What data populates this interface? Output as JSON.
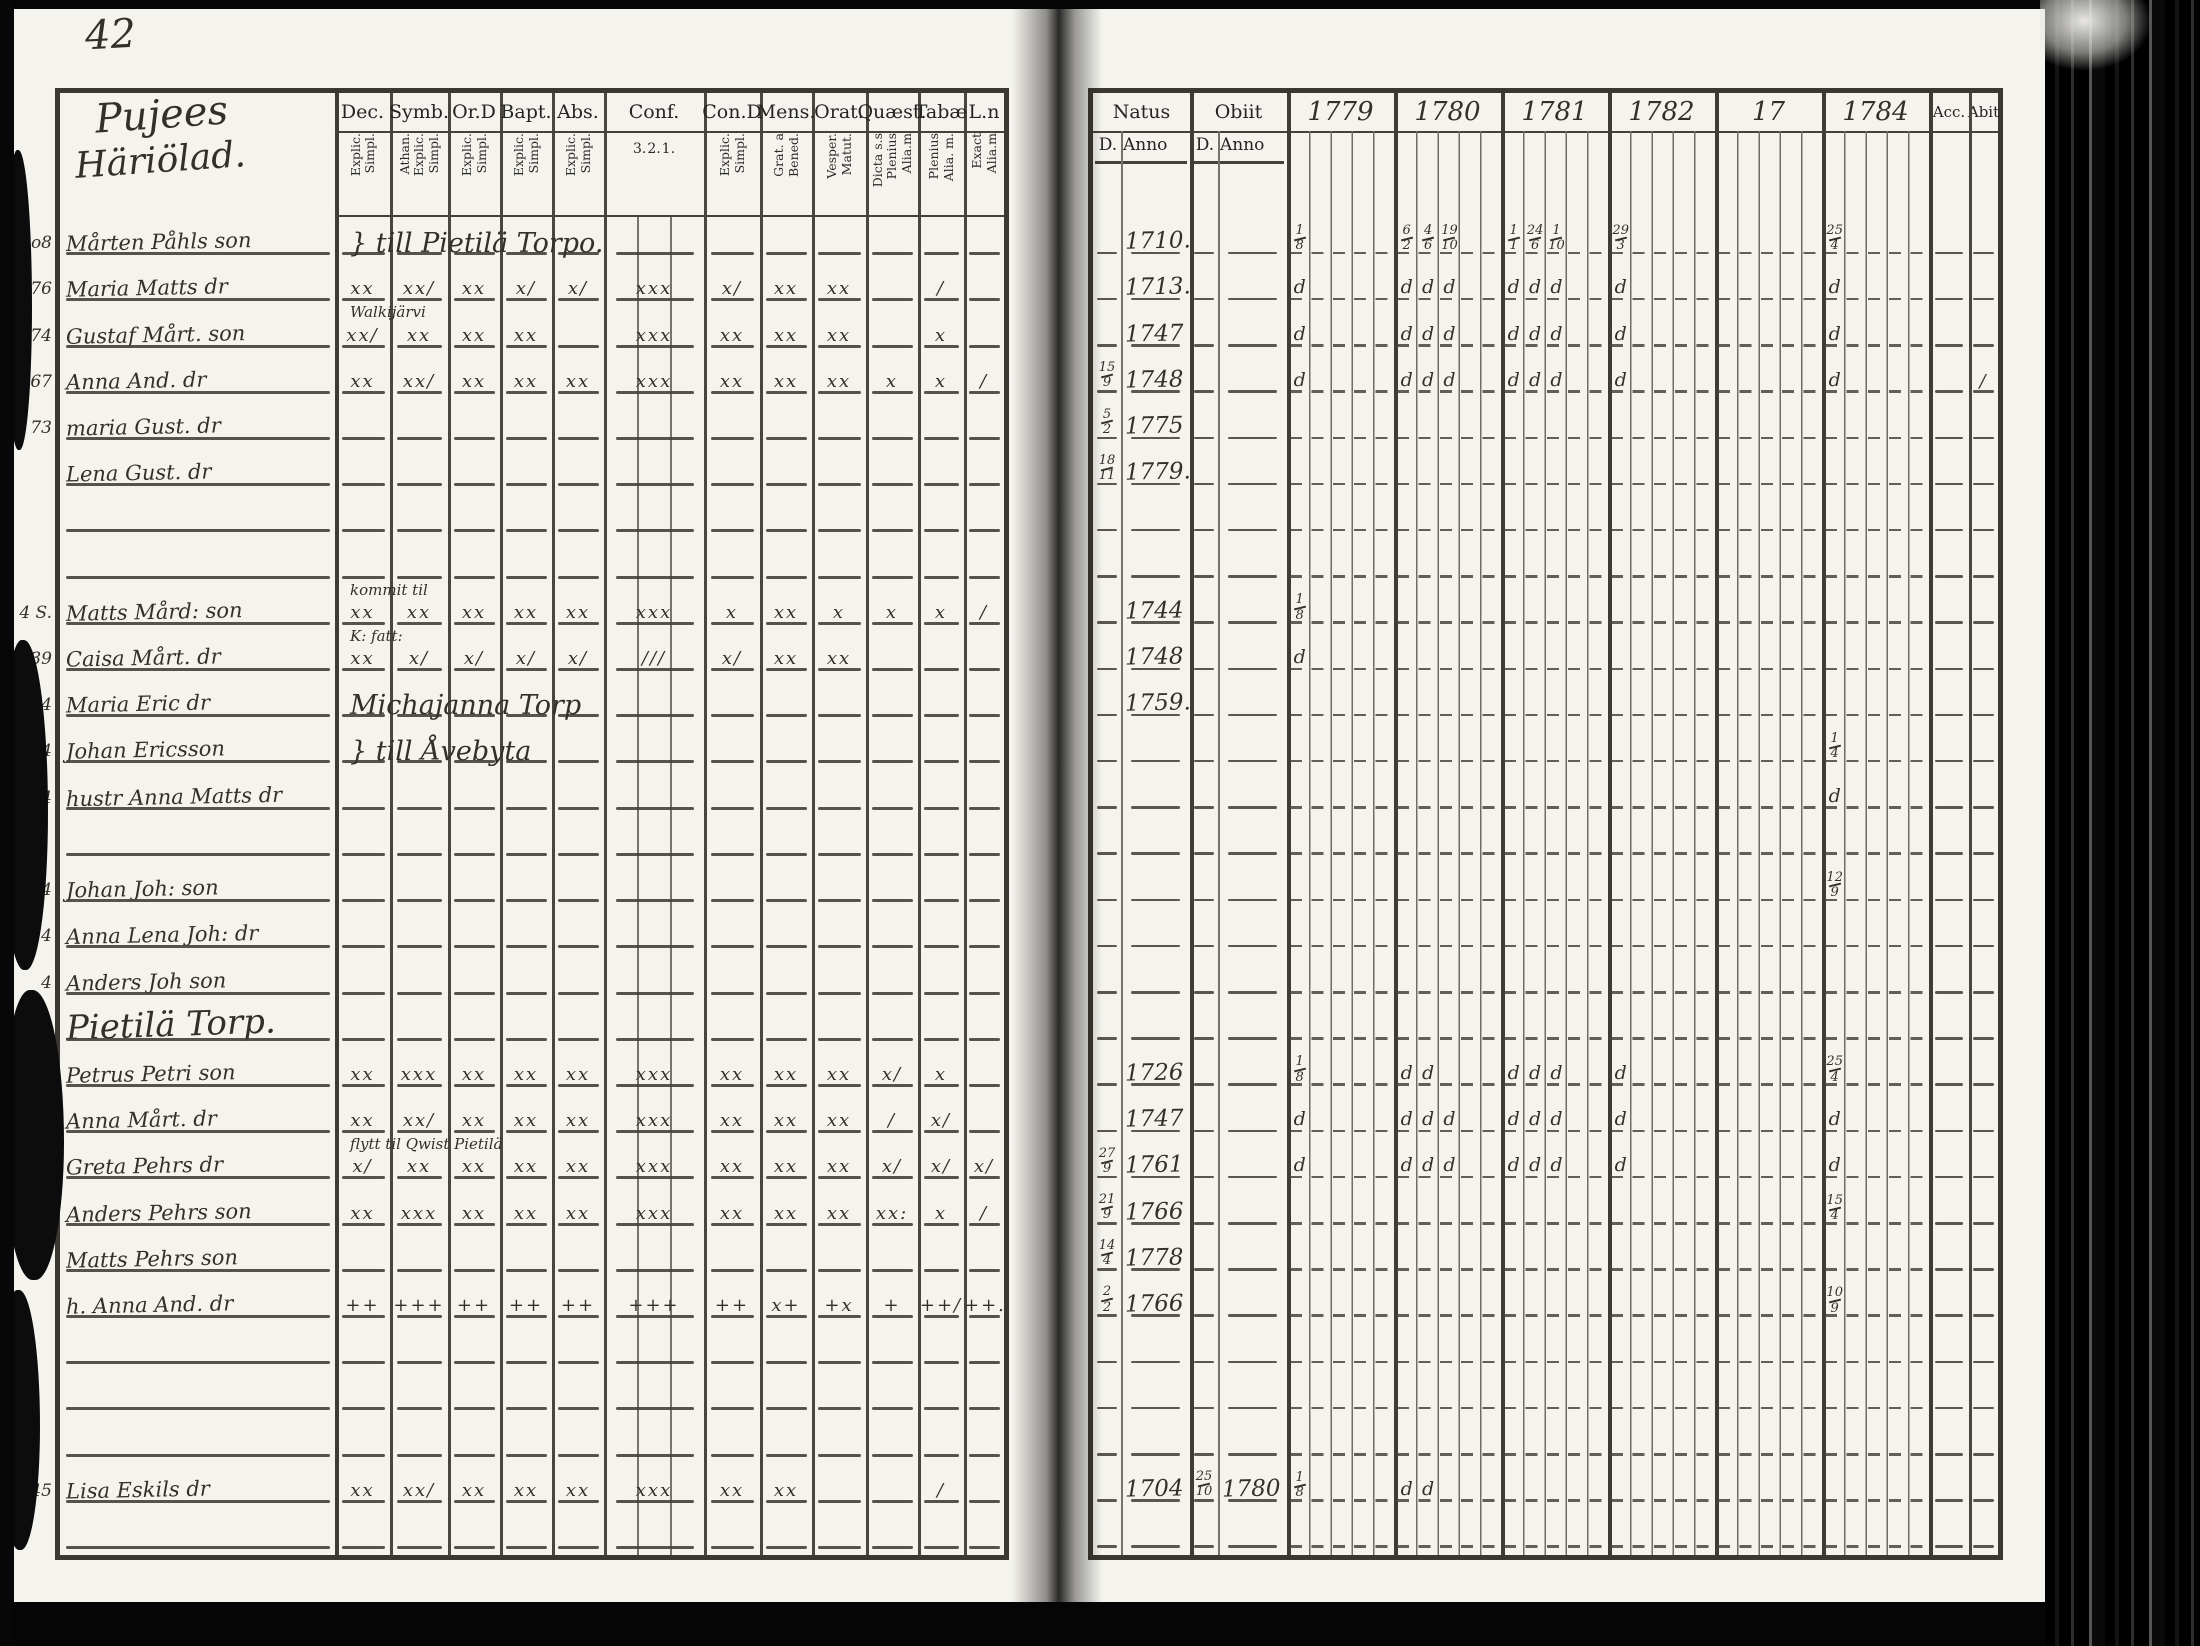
{
  "page_number": "42",
  "left_page": {
    "title_lines": [
      "Pujees",
      "Häriölad."
    ],
    "columns": [
      {
        "label": "Dec.",
        "subs": [
          "Explic.",
          "Simpl."
        ]
      },
      {
        "label": "Symb.",
        "subs": [
          "Athan.",
          "Explic.",
          "Simpl."
        ]
      },
      {
        "label": "Or.D",
        "subs": [
          "Explic.",
          "Simpl."
        ]
      },
      {
        "label": "Bapt.",
        "subs": [
          "Explic.",
          "Simpl."
        ]
      },
      {
        "label": "Abs.",
        "subs": [
          "Explic.",
          "Simpl."
        ]
      },
      {
        "label": "Conf.",
        "subs": [
          "3.",
          "2.",
          "1."
        ],
        "numeric": true
      },
      {
        "label": "Con.D",
        "subs": [
          "Explic.",
          "Simpl."
        ]
      },
      {
        "label": "Mens.",
        "subs": [
          "Grat. a",
          "Bened."
        ]
      },
      {
        "label": "Orat.",
        "subs": [
          "Vesper.",
          "Matut."
        ]
      },
      {
        "label": "Quæst.",
        "subs": [
          "Dicta s.s",
          "Plenius",
          "Alia.m"
        ]
      },
      {
        "label": "Tabæ",
        "subs": [
          "Plenius",
          "Alia. m."
        ]
      },
      {
        "label": "L.n",
        "subs": [
          "Exact",
          "Alia.m"
        ]
      }
    ]
  },
  "right_page": {
    "natus_label": "Natus",
    "obiit_label": "Obiit",
    "day_label": "D.",
    "anno_label": "Anno",
    "year_labels": [
      "1779",
      "1780",
      "1781",
      "1782",
      "17",
      "1784"
    ],
    "acc_label": "Acc.",
    "abit_label": "Abit"
  },
  "rows": [
    {
      "margin": "Lo8",
      "name": "Mårten Påhls son",
      "note": "} till Pietilä Torpo.",
      "note_big": true,
      "natus": "1710.",
      "y1779": [
        "1/8"
      ],
      "y1780": [
        "6/2",
        "4/6",
        "19/10"
      ],
      "y1781": [
        "1/1",
        "24/6",
        "1/10"
      ],
      "y1782": [
        "29/3"
      ],
      "y1784": [
        "25/4"
      ]
    },
    {
      "margin": "76",
      "name": "Maria Matts dr",
      "marks": [
        "xx",
        "xx/",
        "xx",
        "x/",
        "x/",
        "xxx",
        "x/",
        "xx",
        "xx",
        "",
        "/",
        ""
      ],
      "natus": "1713.",
      "y1779": [
        "d"
      ],
      "y1780": [
        "d",
        "d",
        "d"
      ],
      "y1781": [
        "d",
        "d",
        "d"
      ],
      "y1782": [
        "d"
      ],
      "y1784": [
        "d"
      ]
    },
    {
      "margin": "74",
      "name": "Gustaf Mårt. son",
      "note": "Walkijärvi",
      "marks": [
        "xx/",
        "xx",
        "xx",
        "xx",
        "",
        "xxx",
        "xx",
        "xx",
        "xx",
        "",
        "x",
        ""
      ],
      "natus": "1747",
      "y1779": [
        "d"
      ],
      "y1780": [
        "d",
        "d",
        "d"
      ],
      "y1781": [
        "d",
        "d",
        "d"
      ],
      "y1782": [
        "d"
      ],
      "y1784": [
        "d"
      ]
    },
    {
      "margin": "67",
      "name": "Anna And. dr",
      "marks": [
        "xx",
        "xx/",
        "xx",
        "xx",
        "xx",
        "xxx",
        "xx",
        "xx",
        "xx",
        "x",
        "x",
        "/"
      ],
      "natus_d": "15/9",
      "natus": "1748",
      "y1779": [
        "d"
      ],
      "y1780": [
        "d",
        "d",
        "d"
      ],
      "y1781": [
        "d",
        "d",
        "d"
      ],
      "y1782": [
        "d"
      ],
      "y1784": [
        "d"
      ],
      "abit": "/"
    },
    {
      "margin": "73",
      "name": "maria Gust. dr",
      "natus_d": "5/2",
      "natus": "1775"
    },
    {
      "margin": "",
      "name": "Lena Gust. dr",
      "natus_d": "18/11",
      "natus": "1779."
    },
    {},
    {},
    {
      "margin": "4 S.",
      "name": "Matts Mård: son",
      "note": "kommit til",
      "marks": [
        "xx",
        "xx",
        "xx",
        "xx",
        "xx",
        "xxx",
        "x",
        "xx",
        "x",
        "x",
        "x",
        "/"
      ],
      "natus": "1744",
      "y1779": [
        "1/8"
      ]
    },
    {
      "margin": "39",
      "name": "Caisa Mårt. dr",
      "note": "K: fatt:",
      "marks": [
        "xx",
        "x/",
        "x/",
        "x/",
        "x/",
        "///",
        "x/",
        "xx",
        "xx",
        "",
        "",
        ""
      ],
      "natus": "1748",
      "y1779": [
        "d"
      ]
    },
    {
      "margin": "44",
      "name": "Maria Eric dr",
      "note": "Michajanna Torp",
      "note_big": true,
      "natus": "1759."
    },
    {
      "margin": "4",
      "name": "Johan Ericsson",
      "note": "} till Åvebyta",
      "note_big": true,
      "y1784": [
        "1/4"
      ]
    },
    {
      "margin": "4",
      "name": "hustr Anna Matts dr",
      "y1784": [
        "d"
      ]
    },
    {},
    {
      "margin": "4",
      "name": "Johan Joh: son",
      "y1784": [
        "12/9"
      ]
    },
    {
      "margin": "4",
      "name": "Anna Lena Joh: dr"
    },
    {
      "margin": "4",
      "name": "Anders Joh son"
    },
    {
      "section": "Pietilä Torp."
    },
    {
      "margin": "",
      "name": "Petrus Petri son",
      "marks": [
        "xx",
        "xxx",
        "xx",
        "xx",
        "xx",
        "xxx",
        "xx",
        "xx",
        "xx",
        "x/",
        "x",
        ""
      ],
      "natus": "1726",
      "y1779": [
        "1/8"
      ],
      "y1780": [
        "d",
        "d"
      ],
      "y1781": [
        "d",
        "d",
        "d"
      ],
      "y1782": [
        "d"
      ],
      "y1784": [
        "25/4"
      ]
    },
    {
      "margin": "",
      "name": "Anna Mårt. dr",
      "marks": [
        "xx",
        "xx/",
        "xx",
        "xx",
        "xx",
        "xxx",
        "xx",
        "xx",
        "xx",
        "/",
        "x/",
        ""
      ],
      "natus": "1747",
      "y1779": [
        "d"
      ],
      "y1780": [
        "d",
        "d",
        "d"
      ],
      "y1781": [
        "d",
        "d",
        "d"
      ],
      "y1782": [
        "d"
      ],
      "y1784": [
        "d"
      ]
    },
    {
      "margin": "",
      "name": "Greta Pehrs dr",
      "note": "flytt til Qwist Pietilä",
      "marks": [
        "x/",
        "xx",
        "xx",
        "xx",
        "xx",
        "xxx",
        "xx",
        "xx",
        "xx",
        "x/",
        "x/",
        "x/"
      ],
      "natus_d": "27/9",
      "natus": "1761",
      "y1779": [
        "d"
      ],
      "y1780": [
        "d",
        "d",
        "d"
      ],
      "y1781": [
        "d",
        "d",
        "d"
      ],
      "y1782": [
        "d"
      ],
      "y1784": [
        "d"
      ]
    },
    {
      "margin": "",
      "name": "Anders Pehrs son",
      "marks": [
        "xx",
        "xxx",
        "xx",
        "xx",
        "xx",
        "xxx",
        "xx",
        "xx",
        "xx",
        "xx:",
        "x",
        "/"
      ],
      "natus_d": "21/9",
      "natus": "1766",
      "y1784": [
        "15/4"
      ]
    },
    {
      "margin": "",
      "name": "Matts Pehrs son",
      "natus_d": "14/4",
      "natus": "1778"
    },
    {
      "margin": "",
      "name": "h. Anna And. dr",
      "marks": [
        "++",
        "+++",
        "++",
        "++",
        "++",
        "+++",
        "++",
        "x+",
        "+x",
        "+",
        "++/",
        "++."
      ],
      "natus_d": "2/2",
      "natus": "1766",
      "y1784": [
        "10/9"
      ]
    },
    {},
    {},
    {},
    {
      "margin": "45",
      "name": "Lisa Eskils dr",
      "marks": [
        "xx",
        "xx/",
        "xx",
        "xx",
        "xx",
        "xxx",
        "xx",
        "xx",
        "",
        "",
        "/",
        ""
      ],
      "natus": "1704",
      "obiit_d": "25/10",
      "obiit": "1780",
      "y1779": [
        "1/8"
      ],
      "y1780": [
        "d",
        "d"
      ]
    },
    {}
  ]
}
